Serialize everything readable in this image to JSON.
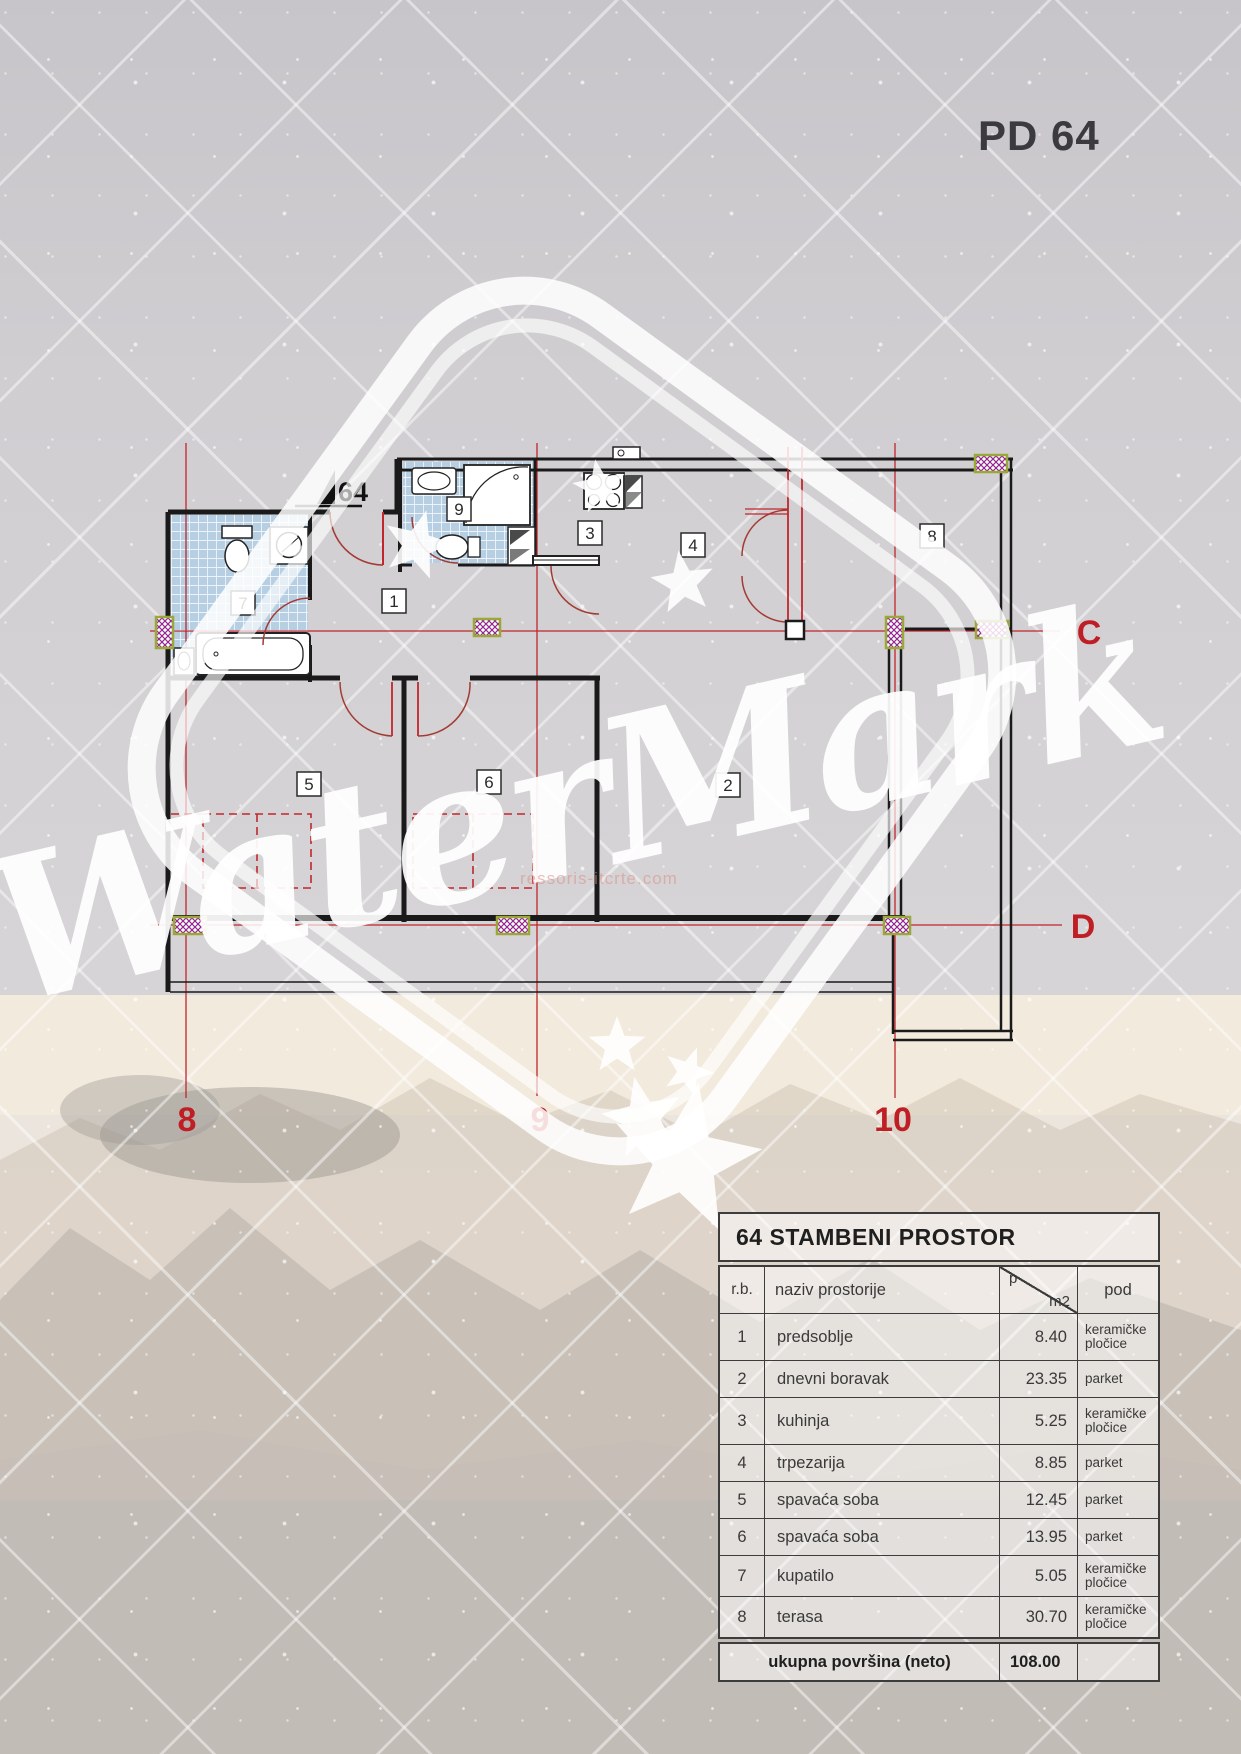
{
  "page": {
    "title": "PD 64"
  },
  "plan": {
    "entry_label": "64",
    "room_labels": {
      "r1": "1",
      "r2": "2",
      "r3": "3",
      "r4": "4",
      "r5": "5",
      "r6": "6",
      "r7": "7",
      "r8": "8",
      "r9": "9"
    },
    "grid": {
      "c": "C",
      "d": "D",
      "g8": "8",
      "g9": "9",
      "g10": "10"
    },
    "colors": {
      "wall": "#1a1a1a",
      "grid_red": "#c0262c",
      "door_red": "#a33b33",
      "tile_blue": "#b7cfe2",
      "column_purple": "#93278f",
      "column_border": "#9aa83a"
    }
  },
  "watermark": {
    "text": "WaterMark",
    "url": "ressoris-itcrte.com"
  },
  "table": {
    "title": "64 STAMBENI PROSTOR",
    "headers": {
      "rb": "r.b.",
      "name": "naziv prostorije",
      "area_top": "p",
      "area_bottom": "m2",
      "floor": "pod"
    },
    "rows": [
      {
        "rb": "1",
        "name": "predsoblje",
        "area": "8.40",
        "floor": "keramičke pločice"
      },
      {
        "rb": "2",
        "name": "dnevni boravak",
        "area": "23.35",
        "floor": "parket"
      },
      {
        "rb": "3",
        "name": "kuhinja",
        "area": "5.25",
        "floor": "keramičke pločice"
      },
      {
        "rb": "4",
        "name": "trpezarija",
        "area": "8.85",
        "floor": "parket"
      },
      {
        "rb": "5",
        "name": "spavaća soba",
        "area": "12.45",
        "floor": "parket"
      },
      {
        "rb": "6",
        "name": "spavaća soba",
        "area": "13.95",
        "floor": "parket"
      },
      {
        "rb": "7",
        "name": "kupatilo",
        "area": "5.05",
        "floor": "keramičke pločice"
      },
      {
        "rb": "8",
        "name": "terasa",
        "area": "30.70",
        "floor": "keramičke pločice"
      }
    ],
    "footer": {
      "label": "ukupna površina (neto)",
      "value": "108.00"
    }
  }
}
